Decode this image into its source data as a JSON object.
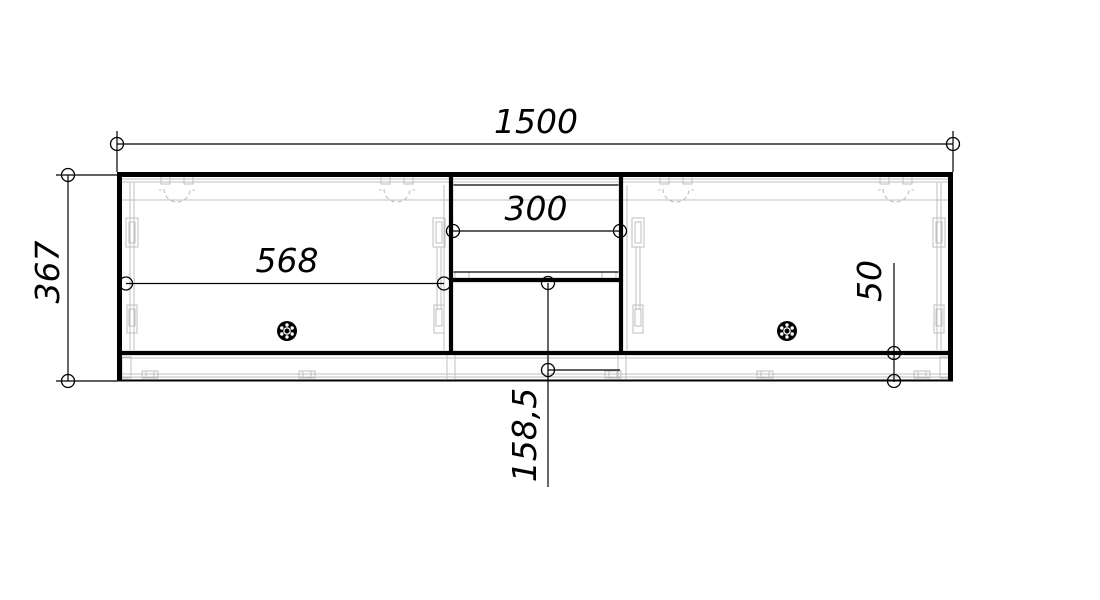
{
  "drawing": {
    "description": "Technical front-elevation drawing of a wall cabinet with two doors and a central open/drawer section",
    "dimensions": {
      "overall_width": "1500",
      "overall_height": "367",
      "left_door_width": "568",
      "middle_section_width": "300",
      "plinth_height": "50",
      "lower_middle_height": "158,5"
    },
    "colors": {
      "line": "#000000",
      "hardware_detail": "#bfbfbf",
      "background": "#ffffff"
    },
    "icons": {
      "dimension_endpoint": "circle-marker",
      "hinge": "hinge-cup-dashed-arc",
      "knob": "black-wheel-knob",
      "clip": "plinth-connector-clip"
    }
  }
}
